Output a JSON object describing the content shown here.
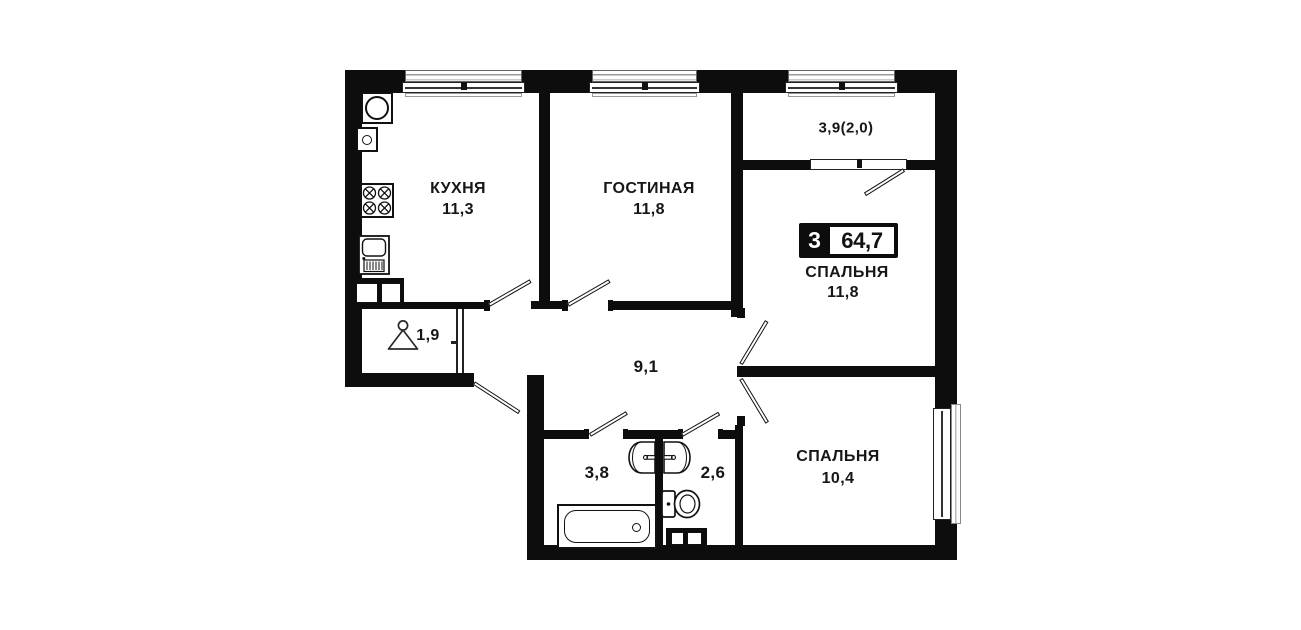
{
  "badge": {
    "rooms_count": "3",
    "total_area": "64,7"
  },
  "rooms": {
    "kitchen": {
      "label": "КУХНЯ",
      "area": "11,3"
    },
    "living_room": {
      "label": "ГОСТИНАЯ",
      "area": "11,8"
    },
    "bedroom_top": {
      "label": "СПАЛЬНЯ",
      "area": "11,8"
    },
    "bedroom_bottom": {
      "label": "СПАЛЬНЯ",
      "area": "10,4"
    },
    "hallway": {
      "area": "9,1"
    },
    "bathroom": {
      "area": "3,8"
    },
    "toilet": {
      "area": "2,6"
    },
    "wardrobe": {
      "area": "1,9"
    },
    "balcony": {
      "area": "3,9(2,0)"
    }
  },
  "colors": {
    "background": "#ffffff",
    "wall": "#0d0d0d",
    "text": "#161616",
    "badge_background": "#0d0d0d",
    "badge_text": "#ffffff"
  },
  "fixtures": [
    "washing-machine",
    "water-heater",
    "stove",
    "kitchen-sink",
    "hanger",
    "bathtub",
    "washbasin-bathroom",
    "washbasin-toilet",
    "toilet-bowl",
    "vent-shaft-kitchen",
    "vent-shaft-bathroom"
  ]
}
